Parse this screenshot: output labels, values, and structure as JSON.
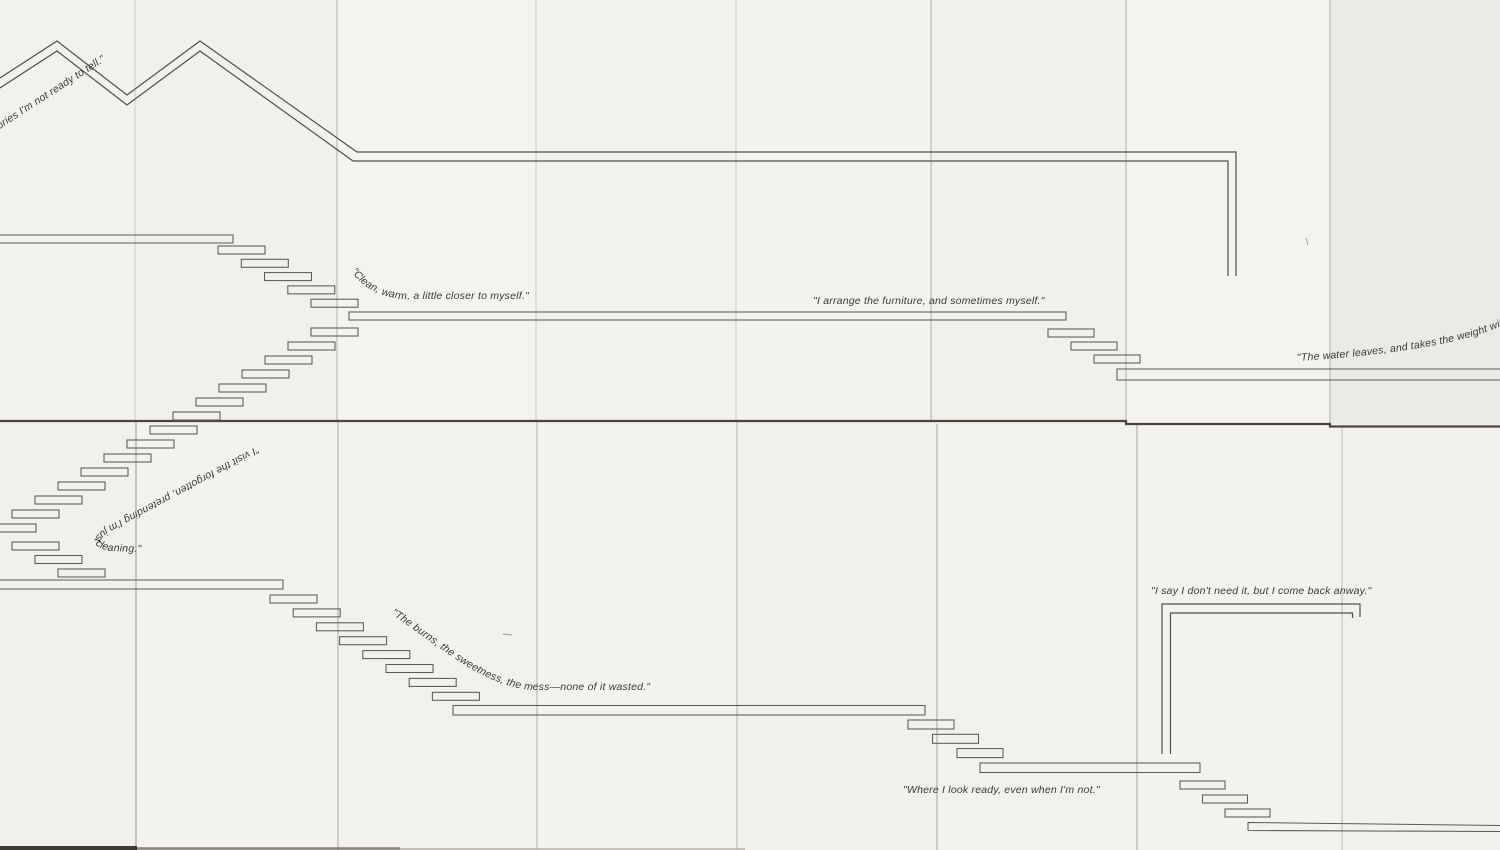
{
  "canvas": {
    "width": 1500,
    "height": 850
  },
  "palette": {
    "paper_base": "#f2f1ed",
    "paper_dark_panel": "#ebeae5",
    "line_ink": "#514f4b",
    "text_ink": "#3b3a38",
    "seam_dark": "#4b443b"
  },
  "quotes": {
    "stories": "stories I'm not ready to tell.\"",
    "clean": "\"Clean, warm, a little closer to myself.\"",
    "arrange": "\"I arrange the furniture, and sometimes myself.\"",
    "water": "\"The water leaves, and takes the weight with it.\"",
    "visit": "\"I visit the forgotten, pretending I'm just cleaning.\"",
    "burns": "\"The burns, the sweetness, the mess—none of it wasted.\"",
    "comeback": "\"I say I don't need it, but I come back anway.\"",
    "ready": "\"Where I look ready, even when I'm not.\""
  }
}
